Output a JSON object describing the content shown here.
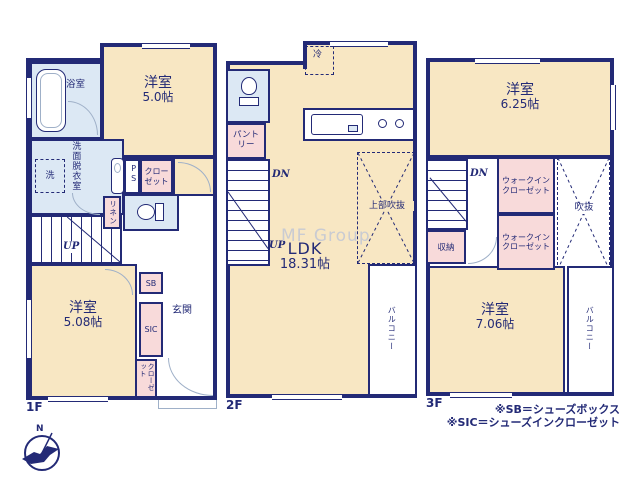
{
  "colors": {
    "wall": "#232a76",
    "room_tan": "#f8e7c3",
    "wet_blue": "#dce8f4",
    "closet_pink": "#f8dada",
    "door_gray": "#9fb0c8",
    "watermark_gray": "#c9cbd2"
  },
  "watermark": "MF Group",
  "compass": {
    "north": "N"
  },
  "floor1": {
    "label": "1F",
    "bath_label": "浴室",
    "bedroom_a_name": "洋室",
    "bedroom_a_size": "5.0帖",
    "washroom_label": "洗面脱衣室",
    "washer_label": "洗",
    "ps_label": "PS",
    "closet_a_label": "クローゼット",
    "linen_label": "リネン",
    "up_label": "UP",
    "bedroom_b_name": "洋室",
    "bedroom_b_size": "5.08帖",
    "sb_label": "SB",
    "sic_label": "SIC",
    "entrance_label": "玄関",
    "closet_b_label": "クローゼット"
  },
  "floor2": {
    "label": "2F",
    "fridge_label": "冷",
    "pantry_label": "パントリー",
    "dn_label": "DN",
    "up_label": "UP",
    "ldk_name": "LDK",
    "ldk_size": "18.31帖",
    "open_above_label": "上部吹抜",
    "balcony_label": "バルコニー"
  },
  "floor3": {
    "label": "3F",
    "bedroom_a_name": "洋室",
    "bedroom_a_size": "6.25帖",
    "dn_label": "DN",
    "wic_a_label": "ウォークインクローゼット",
    "wic_b_label": "ウォークインクローゼット",
    "void_label": "吹抜",
    "storage_label": "収納",
    "bedroom_b_name": "洋室",
    "bedroom_b_size": "7.06帖",
    "balcony_label": "バルコニー"
  },
  "legend": {
    "sb_note": "※SB＝シューズボックス",
    "sic_note": "※SIC＝シューズインクローゼット"
  }
}
